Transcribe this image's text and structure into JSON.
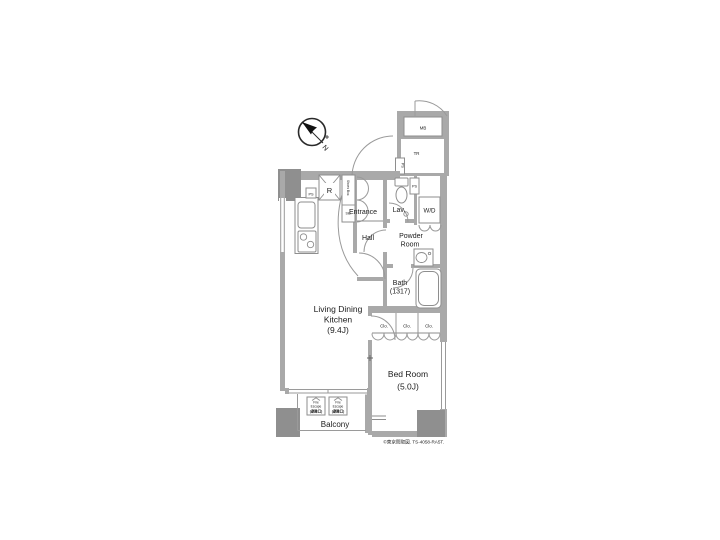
{
  "compass": {
    "north": "N"
  },
  "labels": {
    "mb": "MB",
    "tr": "TR",
    "ps_meter": "PS",
    "ps_kitchen": "PS",
    "ps_lav": "PS",
    "refrigerator": "R",
    "shoes_box": "Shoes Box",
    "storage": "Sto.",
    "entrance": "Entrance",
    "lavatory": "Lav.",
    "washer_dryer": "W/D",
    "hall": "Hall",
    "powder_room": [
      "Powder",
      "Room"
    ],
    "bath": [
      "Bath",
      "(1317)"
    ],
    "ldk": [
      "Living Dining",
      "Kitchen",
      "(9.4J)"
    ],
    "closets": [
      "Clo.",
      "Clo.",
      "Clo."
    ],
    "bedroom": [
      "Bed Room",
      "(5.0J)"
    ],
    "balcony": "Balcony",
    "fire_escape_1": [
      "Fire",
      "Escape",
      "(避難口)"
    ],
    "fire_escape_2": [
      "Fire",
      "Escape",
      "(避難口)"
    ],
    "footer": "©東京間取図. TS-4058-RA5T."
  },
  "colors": {
    "wall": "#a9a9a9",
    "pillar": "#8f8f8f",
    "line": "#8e8e8e",
    "text": "#1c1c1c",
    "background": "#ffffff"
  }
}
